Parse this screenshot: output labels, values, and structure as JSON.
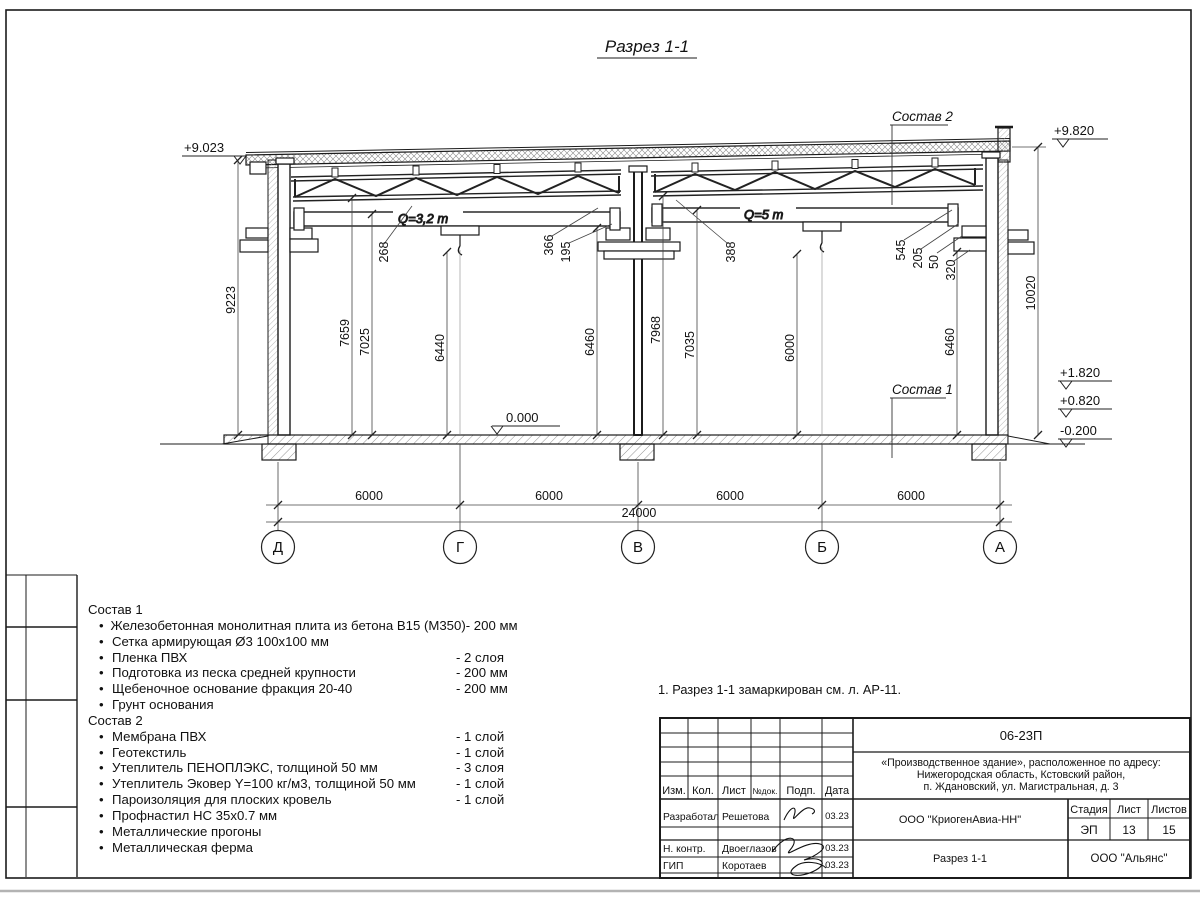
{
  "title": "Разрез 1-1",
  "axes": [
    "Д",
    "Г",
    "В",
    "Б",
    "А"
  ],
  "elevations": {
    "roof_left": "+9.023",
    "roof_right": "+9.820",
    "e1": "+1.820",
    "e2": "+0.820",
    "e3": "-0.200",
    "floor": "0.000"
  },
  "cranes": {
    "left": "Q=3,2 т",
    "right": "Q=5 т"
  },
  "comp_refs": {
    "sostav1": "Состав 1",
    "sostav2": "Состав 2"
  },
  "dims": {
    "left_overall": "9223",
    "right_overall": "10020",
    "v1": "7659",
    "v2": "7025",
    "v3": "6440",
    "v4": "6460",
    "v5": "7968",
    "v6": "7035",
    "v7": "6000",
    "v8": "6460",
    "s1": "268",
    "s2": "366",
    "s3": "195",
    "s4": "388",
    "s5": "545",
    "s6": "205",
    "s7": "50",
    "s8": "320",
    "bottom": [
      "6000",
      "6000",
      "6000",
      "6000"
    ],
    "total": "24000"
  },
  "sostav1": {
    "title": "Состав 1",
    "items": [
      {
        "name": "Железобетонная монолитная плита из бетона В15 (М350)",
        "value": "-  200 мм"
      },
      {
        "name": "Сетка армирующая Ø3 100х100 мм",
        "value": ""
      },
      {
        "name": "Пленка ПВХ",
        "value": "-  2 слоя"
      },
      {
        "name": "Подготовка из песка средней крупности",
        "value": "- 200 мм"
      },
      {
        "name": "Щебеночное основание фракция 20-40",
        "value": "- 200 мм"
      },
      {
        "name": "Грунт основания",
        "value": ""
      }
    ]
  },
  "sostav2": {
    "title": "Состав 2",
    "items": [
      {
        "name": "Мембрана ПВХ",
        "value": "- 1 слой"
      },
      {
        "name": "Геотекстиль",
        "value": "- 1 слой"
      },
      {
        "name": "Утеплитель ПЕНОПЛЭКС, толщиной 50 мм",
        "value": "- 3 слоя"
      },
      {
        "name": "Утеплитель Эковер Y=100 кг/м3, толщиной 50 мм",
        "value": "- 1 слой"
      },
      {
        "name": "Пароизоляция для плоских кровель",
        "value": "- 1 слой"
      },
      {
        "name": "Профнастил НС 35х0.7 мм",
        "value": ""
      },
      {
        "name": "Металлические прогоны",
        "value": ""
      },
      {
        "name": "Металлическая ферма",
        "value": ""
      }
    ]
  },
  "note": "1. Разрез 1-1 замаркирован см. л. АР-11.",
  "titleblock": {
    "doc_number": "06-23П",
    "address1": "«Производственное здание», расположенное по адресу:",
    "address2": "Нижегородская область, Кстовский район,",
    "address3": "п. Ждановский, ул. Магистральная, д. 3",
    "col_izm": "Изм.",
    "col_kol": "Кол.",
    "col_list": "Лист",
    "col_ndok": "№док.",
    "col_podp": "Подп.",
    "col_data": "Дата",
    "row1_role": "Разработал",
    "row1_name": "Решетова",
    "row1_date": "03.23",
    "row2_role": "Н. контр.",
    "row2_name": "Двоеглазов",
    "row2_date": "03.23",
    "row3_role": "ГИП",
    "row3_name": "Коротаев",
    "row3_date": "03.23",
    "company": "ООО \"КриогенАвиа-НН\"",
    "stage_label": "Стадия",
    "sheet_label": "Лист",
    "sheets_label": "Листов",
    "stage": "ЭП",
    "sheet": "13",
    "sheets": "15",
    "section_name": "Разрез 1-1",
    "org": "ООО \"Альянс\""
  }
}
